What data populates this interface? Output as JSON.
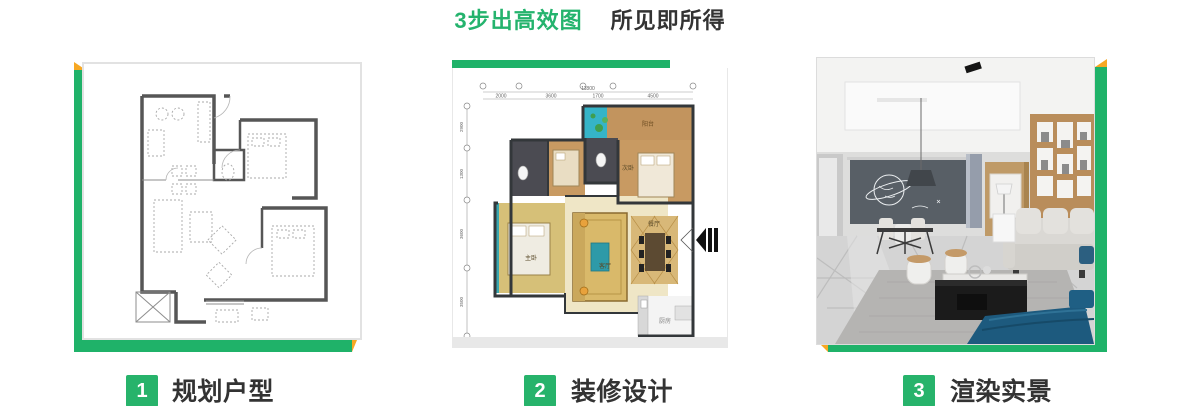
{
  "title": {
    "highlight": "3步出高效图",
    "subtitle": "所见即所得"
  },
  "colors": {
    "green": "#1fb269",
    "yellow": "#f7a823",
    "text_dark": "#333333"
  },
  "steps": [
    {
      "number": "1",
      "label": "规划户型"
    },
    {
      "number": "2",
      "label": "装修设计"
    },
    {
      "number": "3",
      "label": "渲染实景"
    }
  ],
  "floorplan": {
    "total_width": "11800",
    "top_dimensions": [
      "2000",
      "3600",
      "1700",
      "4500"
    ],
    "left_dimensions": [
      "2900",
      "1300",
      "3600",
      "3500"
    ],
    "rooms": {
      "balcony": "阳台",
      "bedroom": "次卧",
      "master": "主卧",
      "living": "客厅",
      "dining": "餐厅",
      "kitchen": "厨房"
    }
  }
}
